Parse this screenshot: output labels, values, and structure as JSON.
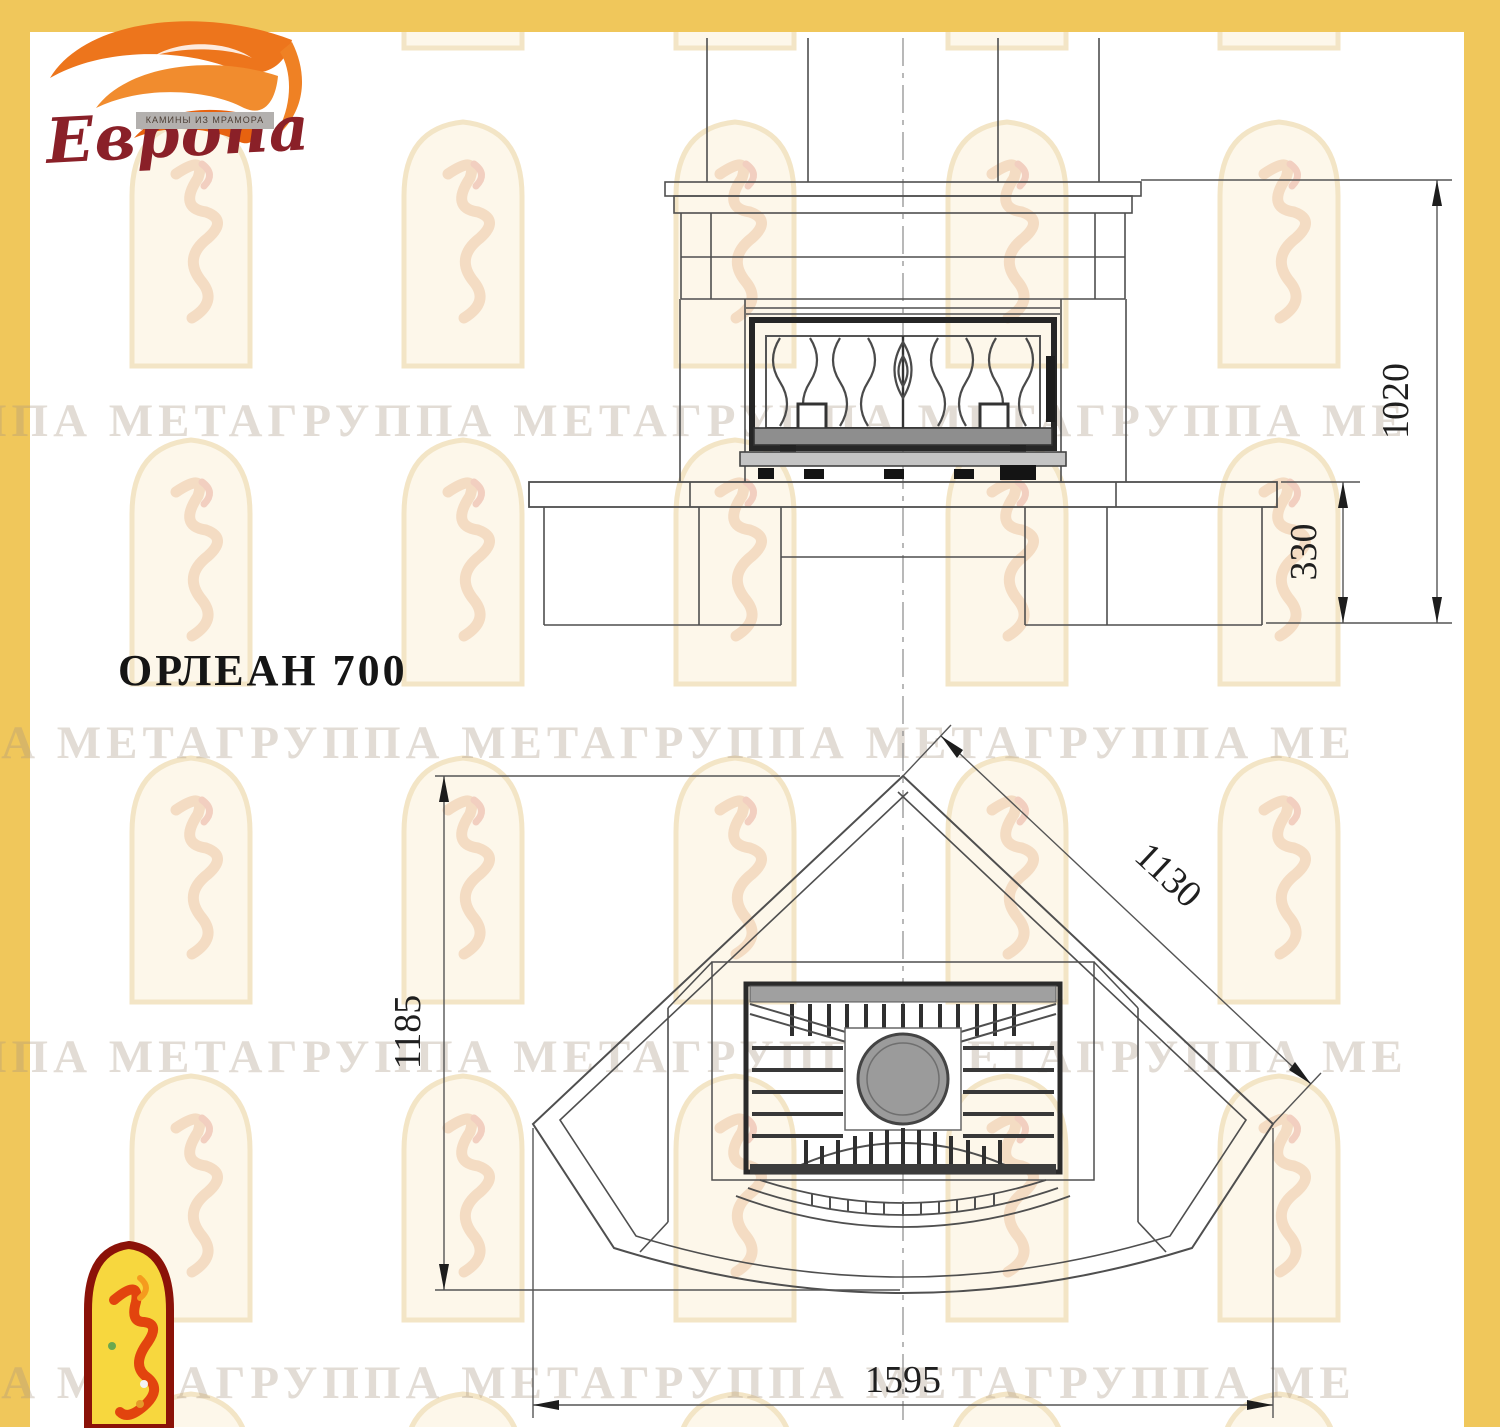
{
  "title": "ОРЛЕАН 700",
  "logo": {
    "brand": "Европа",
    "tagline": "КАМИНЫ ИЗ МРАМОРА"
  },
  "watermark": {
    "row_text": "ППА МЕТАГРУППА МЕТАГРУППА МЕТАГРУППА МЕ"
  },
  "dims": {
    "front": {
      "overall_height": "1020",
      "base_height": "330"
    },
    "plan": {
      "depth": "1185",
      "side": "1130",
      "width": "1595"
    }
  },
  "colors": {
    "border": "#F0C75B",
    "line": "#4f4f4f",
    "logo_flame": "#ee7a1c",
    "logo_text": "#8a2028"
  }
}
